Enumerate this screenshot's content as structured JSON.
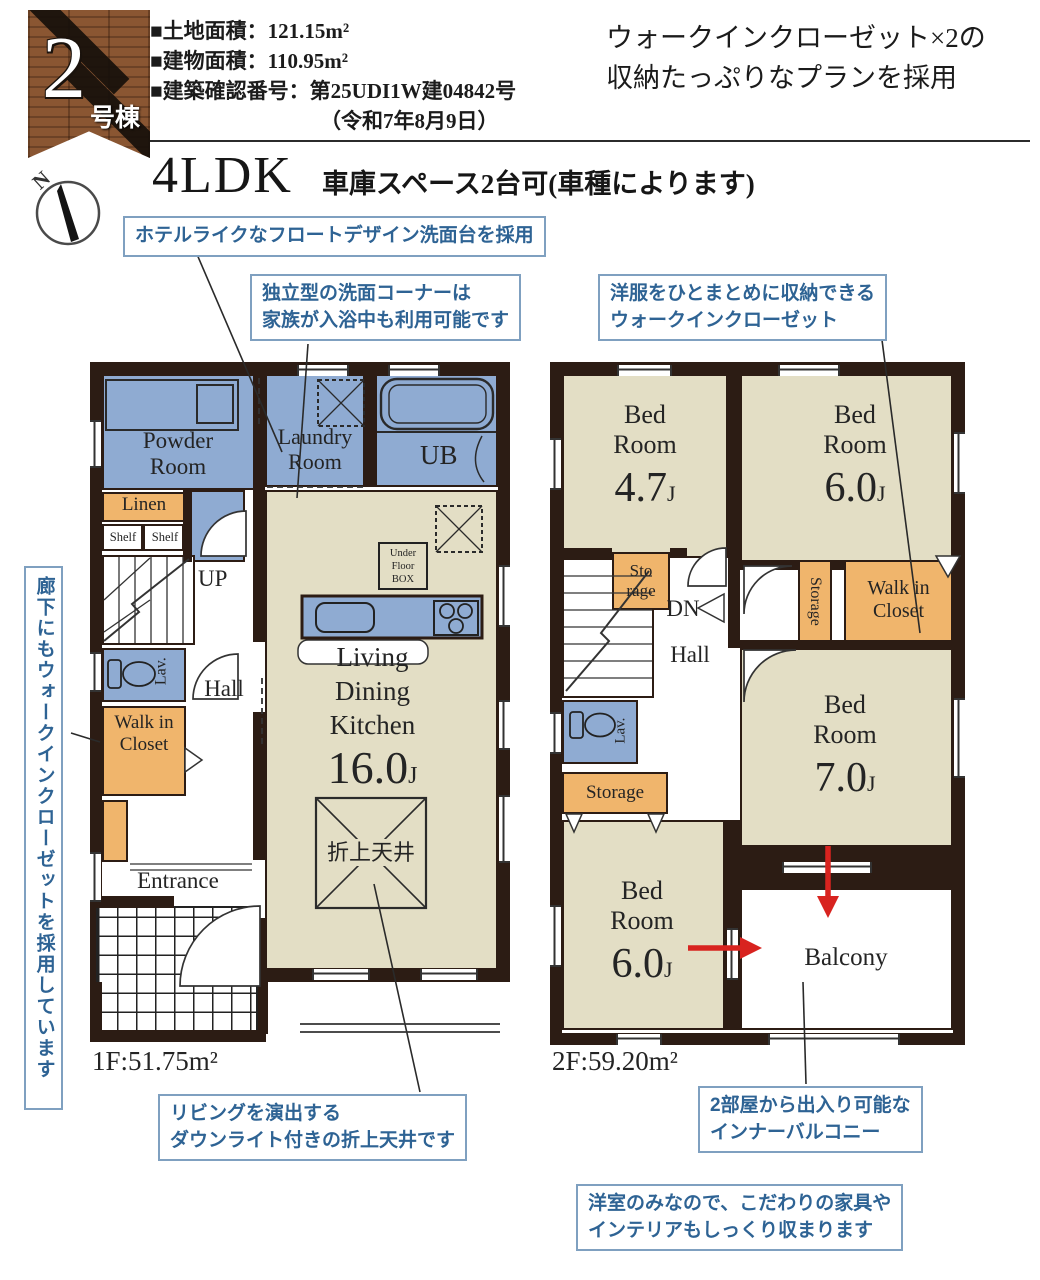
{
  "header": {
    "badge_number": "2",
    "badge_suffix": "号棟",
    "spec_line1": "■土地面積：121.15m²",
    "spec_line2": "■建物面積：110.95m²",
    "spec_line3": "■建築確認番号：第25UDI1W建04842号",
    "spec_line4": "（令和7年8月9日）",
    "headline_line1": "ウォークインクローゼット×2の",
    "headline_line2": "収納たっぷりなプランを採用",
    "plan_type": "4LDK",
    "plan_note": "車庫スペース2台可(車種によります)",
    "compass_n": "N"
  },
  "callouts": {
    "powder": "ホテルライクなフロートデザイン洗面台を採用",
    "laundry_line1": "独立型の洗面コーナーは",
    "laundry_line2": "家族が入浴中も利用可能です",
    "wic2f_line1": "洋服をひとまとめに収納できる",
    "wic2f_line2": "ウォークインクローゼット",
    "hallway_wic": "廊下にもウォークインクローゼットを採用しています",
    "ceiling_line1": "リビングを演出する",
    "ceiling_line2": "ダウンライト付きの折上天井です",
    "balcony_line1": "2部屋から出入り可能な",
    "balcony_line2": "インナーバルコニー",
    "rooms_line1": "洋室のみなので、こだわりの家具や",
    "rooms_line2": "インテリアもしっくり収まります"
  },
  "floor1": {
    "area_label": "1F:51.75m²",
    "powder": "Powder Room",
    "laundry": "Laundry Room",
    "ub": "UB",
    "linen": "Linen",
    "shelf1": "Shelf",
    "shelf2": "Shelf",
    "up": "UP",
    "hall": "Hall",
    "lav": "Lav.",
    "wic": "Walk in Closet",
    "entrance": "Entrance",
    "ldk_label": "Living Dining Kitchen",
    "ldk_size": "16.0",
    "ldk_unit": "J",
    "ceiling_box": "折上天井",
    "underfloor_line1": "Under",
    "underfloor_line2": "Floor",
    "underfloor_line3": "BOX"
  },
  "floor2": {
    "area_label": "2F:59.20m²",
    "bed1_label": "Bed Room",
    "bed1_size": "4.7",
    "bed1_unit": "J",
    "bed2_label": "Bed Room",
    "bed2_size": "6.0",
    "bed2_unit": "J",
    "bed3_label": "Bed Room",
    "bed3_size": "7.0",
    "bed3_unit": "J",
    "bed4_label": "Bed Room",
    "bed4_size": "6.0",
    "bed4_unit": "J",
    "storage_small_line1": "Sto",
    "storage_small_line2": "rage",
    "storage_vertical": "Storage",
    "storage_lower": "Storage",
    "wic": "Walk in Closet",
    "dn": "DN",
    "hall": "Hall",
    "lav": "Lav.",
    "balcony": "Balcony"
  },
  "colors": {
    "wall": "#2c1c14",
    "room_blue": "#8fabd2",
    "room_beige": "#e3dec5",
    "room_orange": "#f0b56c",
    "callout_blue": "#2e6394",
    "arrow_red": "#d8231f"
  }
}
